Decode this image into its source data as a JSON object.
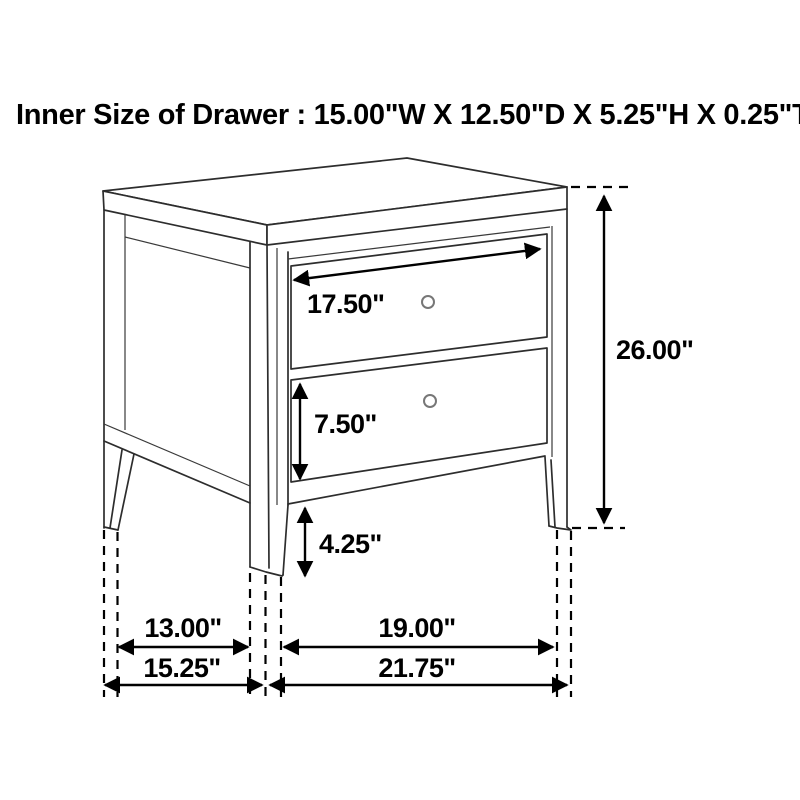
{
  "header": {
    "title": "Inner Size of Drawer : 15.00\"W X 12.50\"D X 5.25\"H X 0.25\"T"
  },
  "diagram": {
    "type": "furniture-dimension-diagram",
    "labels": {
      "drawer_face_width": "17.50\"",
      "overall_height": "26.00\"",
      "bottom_drawer_face_height": "7.50\"",
      "leg_height": "4.25\"",
      "side_leg_spacing": "13.00\"",
      "front_leg_spacing": "19.00\"",
      "overall_depth": "15.25\"",
      "overall_width": "21.75\""
    },
    "inner_drawer_size": {
      "width": "15.00\"",
      "depth": "12.50\"",
      "height": "5.25\"",
      "thickness": "0.25\""
    },
    "colors": {
      "line": "#2d2d2d",
      "dimension": "#000000",
      "knob": "#777777",
      "background": "#ffffff"
    }
  }
}
